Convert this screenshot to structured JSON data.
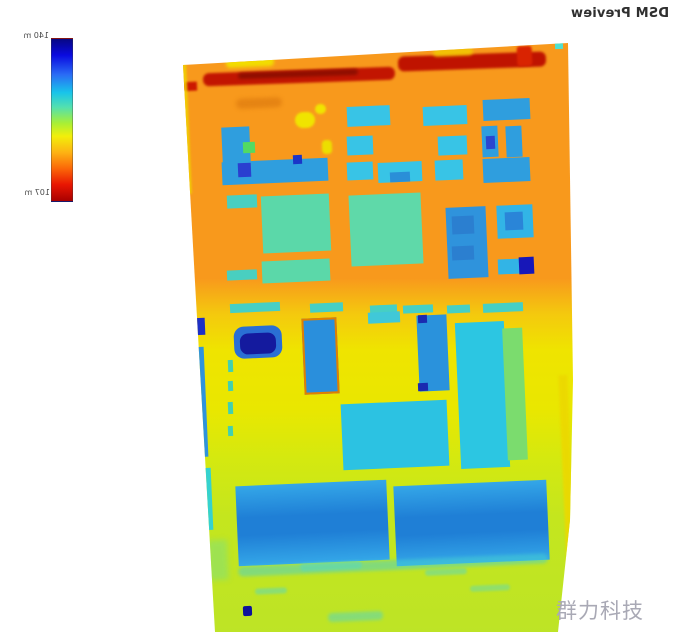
{
  "header": {
    "title": "DSM Preview"
  },
  "colorbar": {
    "max_label": "140 m",
    "min_label": "107 m",
    "gradient": [
      "#070783 0%",
      "#0a0ae0 10%",
      "#2a6cf5 22%",
      "#18c4ea 33%",
      "#52e0b0 42%",
      "#a8ef35 52%",
      "#f2ef0a 60%",
      "#fdb313 70%",
      "#fb6708 80%",
      "#e81602 90%",
      "#a80000 100%"
    ]
  },
  "watermark": {
    "text": "群力科技",
    "color": "#a9a9b5"
  },
  "map": {
    "bg_gradient": [
      "#f8991c 0%",
      "#f8991c 40%",
      "#f4c90e 46%",
      "#efe400 52%",
      "#e9e700 62%",
      "#d5e90f 70%",
      "#c4e61e 80%",
      "#bde426 100%"
    ],
    "regions": [
      {
        "name": "tree-row-left",
        "x": 25,
        "y": 30,
        "w": 192,
        "h": 13,
        "color": "#c21501",
        "rot": -2,
        "blur": 1.2,
        "radius": 6
      },
      {
        "name": "tree-row-right",
        "x": 220,
        "y": 14,
        "w": 148,
        "h": 15,
        "color": "#bf1300",
        "rot": -2,
        "blur": 1.2,
        "radius": 6
      },
      {
        "name": "tree-row-core",
        "x": 60,
        "y": 31,
        "w": 120,
        "h": 6,
        "color": "#8f0e00",
        "rot": -2,
        "blur": 1.5,
        "radius": 3
      },
      {
        "name": "tree-row-edge",
        "x": 0,
        "y": 42,
        "w": 19,
        "h": 9,
        "color": "#cc1800",
        "blur": 1
      },
      {
        "name": "red-patch",
        "x": 339,
        "y": 6,
        "w": 15,
        "h": 20,
        "color": "#d92301",
        "blur": 1,
        "radius": 3
      },
      {
        "name": "yellow-strip",
        "x": 48,
        "y": 16,
        "w": 48,
        "h": 11,
        "color": "#f2dc00",
        "blur": 1.5,
        "radius": 4
      },
      {
        "name": "yellow-strip",
        "x": 255,
        "y": 8,
        "w": 40,
        "h": 8,
        "color": "#f0cc00",
        "blur": 1.5,
        "radius": 4,
        "opacity": 0.8
      },
      {
        "name": "shrub-smudge",
        "x": 58,
        "y": 58,
        "w": 46,
        "h": 10,
        "color": "#e07d10",
        "blur": 2,
        "opacity": 0.75,
        "radius": 5
      },
      {
        "name": "yellow-blob",
        "x": 117,
        "y": 72,
        "w": 20,
        "h": 16,
        "color": "#f0e400",
        "blur": 1,
        "radius": 8
      },
      {
        "name": "yellow-blob",
        "x": 137,
        "y": 64,
        "w": 11,
        "h": 10,
        "color": "#f0e400",
        "blur": 1,
        "radius": 5
      },
      {
        "name": "yellow-blob",
        "x": 144,
        "y": 100,
        "w": 10,
        "h": 14,
        "color": "#ecde00",
        "blur": 1,
        "radius": 4
      },
      {
        "name": "building",
        "x": 169,
        "y": 66,
        "w": 43,
        "h": 20,
        "color": "#38c4e6"
      },
      {
        "name": "building",
        "x": 245,
        "y": 66,
        "w": 44,
        "h": 19,
        "color": "#38c4e6"
      },
      {
        "name": "building",
        "x": 305,
        "y": 59,
        "w": 47,
        "h": 21,
        "color": "#2f9ede"
      },
      {
        "name": "building",
        "x": 169,
        "y": 96,
        "w": 26,
        "h": 19,
        "color": "#38c4e6"
      },
      {
        "name": "building",
        "x": 260,
        "y": 96,
        "w": 29,
        "h": 19,
        "color": "#38c4e6"
      },
      {
        "name": "building",
        "x": 304,
        "y": 86,
        "w": 16,
        "h": 31,
        "color": "#2f9ede"
      },
      {
        "name": "building-core",
        "x": 308,
        "y": 96,
        "w": 9,
        "h": 13,
        "color": "#2a46cf"
      },
      {
        "name": "building",
        "x": 328,
        "y": 86,
        "w": 16,
        "h": 31,
        "color": "#2f9ede"
      },
      {
        "name": "building-l-vertical",
        "x": 44,
        "y": 87,
        "w": 28,
        "h": 36,
        "color": "#2f9ede"
      },
      {
        "name": "building-l-horizontal",
        "x": 44,
        "y": 120,
        "w": 106,
        "h": 23,
        "color": "#2f9ede"
      },
      {
        "name": "building-annex-green",
        "x": 65,
        "y": 102,
        "w": 12,
        "h": 11,
        "color": "#52da62"
      },
      {
        "name": "building-core",
        "x": 60,
        "y": 123,
        "w": 13,
        "h": 14,
        "color": "#2a3fd0"
      },
      {
        "name": "building-core",
        "x": 115,
        "y": 115,
        "w": 9,
        "h": 9,
        "color": "#1a35c8"
      },
      {
        "name": "building",
        "x": 169,
        "y": 122,
        "w": 26,
        "h": 18,
        "color": "#38c4e6"
      },
      {
        "name": "building",
        "x": 200,
        "y": 122,
        "w": 44,
        "h": 20,
        "color": "#38c4e6"
      },
      {
        "name": "building-core",
        "x": 212,
        "y": 132,
        "w": 20,
        "h": 10,
        "color": "#2a8fd8"
      },
      {
        "name": "building",
        "x": 257,
        "y": 120,
        "w": 28,
        "h": 20,
        "color": "#38c4e6"
      },
      {
        "name": "building",
        "x": 305,
        "y": 118,
        "w": 47,
        "h": 24,
        "color": "#2f9ede"
      },
      {
        "name": "building",
        "x": 49,
        "y": 155,
        "w": 30,
        "h": 13,
        "color": "#49cfc0"
      },
      {
        "name": "building",
        "x": 84,
        "y": 155,
        "w": 68,
        "h": 57,
        "color": "#5bd8a9"
      },
      {
        "name": "building",
        "x": 84,
        "y": 220,
        "w": 68,
        "h": 22,
        "color": "#5bd8a9"
      },
      {
        "name": "building",
        "x": 49,
        "y": 230,
        "w": 30,
        "h": 10,
        "color": "#49cfc0"
      },
      {
        "name": "building",
        "x": 172,
        "y": 154,
        "w": 72,
        "h": 71,
        "color": "#5fd9a9"
      },
      {
        "name": "building",
        "x": 269,
        "y": 167,
        "w": 40,
        "h": 71,
        "color": "#2f93dc"
      },
      {
        "name": "building-core",
        "x": 274,
        "y": 176,
        "w": 22,
        "h": 18,
        "color": "#2b7fd0"
      },
      {
        "name": "building-core",
        "x": 274,
        "y": 206,
        "w": 22,
        "h": 14,
        "color": "#2b7fd0"
      },
      {
        "name": "building",
        "x": 319,
        "y": 165,
        "w": 36,
        "h": 33,
        "color": "#32b4e6"
      },
      {
        "name": "building-core",
        "x": 327,
        "y": 172,
        "w": 18,
        "h": 18,
        "color": "#2a85d8"
      },
      {
        "name": "building",
        "x": 320,
        "y": 219,
        "w": 24,
        "h": 15,
        "color": "#32b4e6"
      },
      {
        "name": "building-core",
        "x": 341,
        "y": 217,
        "w": 15,
        "h": 17,
        "color": "#1717b8"
      },
      {
        "name": "low-structure",
        "x": 52,
        "y": 263,
        "w": 50,
        "h": 9,
        "color": "#46cfc4"
      },
      {
        "name": "low-structure",
        "x": 132,
        "y": 263,
        "w": 33,
        "h": 9,
        "color": "#46cfc4"
      },
      {
        "name": "low-structure",
        "x": 192,
        "y": 265,
        "w": 27,
        "h": 8,
        "color": "#46cfc4"
      },
      {
        "name": "low-structure",
        "x": 225,
        "y": 265,
        "w": 30,
        "h": 8,
        "color": "#46cfc4"
      },
      {
        "name": "low-structure",
        "x": 269,
        "y": 265,
        "w": 23,
        "h": 8,
        "color": "#46cfc4"
      },
      {
        "name": "low-structure",
        "x": 305,
        "y": 263,
        "w": 40,
        "h": 9,
        "color": "#46cfc4"
      },
      {
        "name": "building-core",
        "x": 14,
        "y": 278,
        "w": 13,
        "h": 17,
        "color": "#1d2fc6"
      },
      {
        "name": "building",
        "x": 15,
        "y": 307,
        "w": 13,
        "h": 110,
        "color": "#2f93dc"
      },
      {
        "name": "building",
        "x": 56,
        "y": 286,
        "w": 48,
        "h": 32,
        "color": "#2a6fd4",
        "radius": 10
      },
      {
        "name": "building-core",
        "x": 62,
        "y": 293,
        "w": 36,
        "h": 21,
        "color": "#141a9e",
        "radius": 8
      },
      {
        "name": "building-bordered",
        "x": 125,
        "y": 278,
        "w": 31,
        "h": 72,
        "color": "#2a8fdc",
        "border": "#e07f00"
      },
      {
        "name": "low-structure",
        "x": 190,
        "y": 272,
        "w": 32,
        "h": 11,
        "color": "#40c8d8"
      },
      {
        "name": "building",
        "x": 240,
        "y": 275,
        "w": 30,
        "h": 76,
        "color": "#2a92dc"
      },
      {
        "name": "building-core",
        "x": 240,
        "y": 275,
        "w": 9,
        "h": 8,
        "color": "#1a2ab0"
      },
      {
        "name": "building-core",
        "x": 240,
        "y": 343,
        "w": 10,
        "h": 8,
        "color": "#1a2ab0"
      },
      {
        "name": "building",
        "x": 280,
        "y": 282,
        "w": 49,
        "h": 146,
        "color": "#2cc6e2"
      },
      {
        "name": "building-annex-green",
        "x": 327,
        "y": 288,
        "w": 20,
        "h": 132,
        "color": "#7bdc6e"
      },
      {
        "name": "building",
        "x": 164,
        "y": 362,
        "w": 106,
        "h": 66,
        "color": "#2cc2e2"
      },
      {
        "name": "marking",
        "x": 50,
        "y": 320,
        "w": 5,
        "h": 12,
        "color": "#43d0ae"
      },
      {
        "name": "marking",
        "x": 50,
        "y": 341,
        "w": 5,
        "h": 10,
        "color": "#43d0ae"
      },
      {
        "name": "marking",
        "x": 50,
        "y": 362,
        "w": 5,
        "h": 12,
        "color": "#43d0ae"
      },
      {
        "name": "marking",
        "x": 50,
        "y": 386,
        "w": 5,
        "h": 10,
        "color": "#43d0ae"
      },
      {
        "name": "low-structure",
        "x": 22,
        "y": 428,
        "w": 12,
        "h": 62,
        "color": "#35d2cf"
      },
      {
        "name": "building-large",
        "x": 59,
        "y": 443,
        "w": 151,
        "h": 80,
        "color": "#34a7e8",
        "color2": "#1f7fd6"
      },
      {
        "name": "building-large",
        "x": 217,
        "y": 443,
        "w": 153,
        "h": 80,
        "color": "#34a7e8",
        "color2": "#1f7fd6"
      },
      {
        "name": "streak",
        "x": 60,
        "y": 520,
        "w": 310,
        "h": 10,
        "color": "#45d0d0",
        "opacity": 0.5,
        "blur": 1.5,
        "radius": 5
      },
      {
        "name": "marking-dot",
        "x": 65,
        "y": 566,
        "w": 9,
        "h": 10,
        "color": "#0e129a",
        "radius": 2
      },
      {
        "name": "streak",
        "x": 122,
        "y": 522,
        "w": 62,
        "h": 8,
        "color": "#57d8c2",
        "opacity": 0.55,
        "blur": 1,
        "radius": 4
      },
      {
        "name": "streak",
        "x": 247,
        "y": 529,
        "w": 42,
        "h": 6,
        "color": "#57d8c2",
        "opacity": 0.5,
        "blur": 1,
        "radius": 3
      },
      {
        "name": "streak",
        "x": 77,
        "y": 548,
        "w": 32,
        "h": 6,
        "color": "#57d8c2",
        "opacity": 0.5,
        "blur": 1,
        "radius": 3
      },
      {
        "name": "streak",
        "x": 292,
        "y": 545,
        "w": 40,
        "h": 6,
        "color": "#57d8c2",
        "opacity": 0.45,
        "blur": 1,
        "radius": 3
      },
      {
        "name": "streak",
        "x": 150,
        "y": 572,
        "w": 55,
        "h": 9,
        "color": "#4fd4c8",
        "opacity": 0.5,
        "blur": 1.5,
        "radius": 4
      },
      {
        "name": "streak",
        "x": 30,
        "y": 500,
        "w": 20,
        "h": 40,
        "color": "#6adf9a",
        "opacity": 0.4,
        "blur": 3
      },
      {
        "name": "edge-highlight",
        "x": 3,
        "y": 24,
        "w": 8,
        "h": 130,
        "color": "#efd400",
        "opacity": 0.85,
        "blur": 1
      },
      {
        "name": "edge-highlight",
        "x": 385,
        "y": 335,
        "w": 9,
        "h": 215,
        "color": "#ecd800",
        "opacity": 0.9,
        "blur": 1
      },
      {
        "name": "corner-pixel",
        "x": 377,
        "y": 3,
        "w": 8,
        "h": 6,
        "color": "#50e0d0"
      }
    ]
  }
}
